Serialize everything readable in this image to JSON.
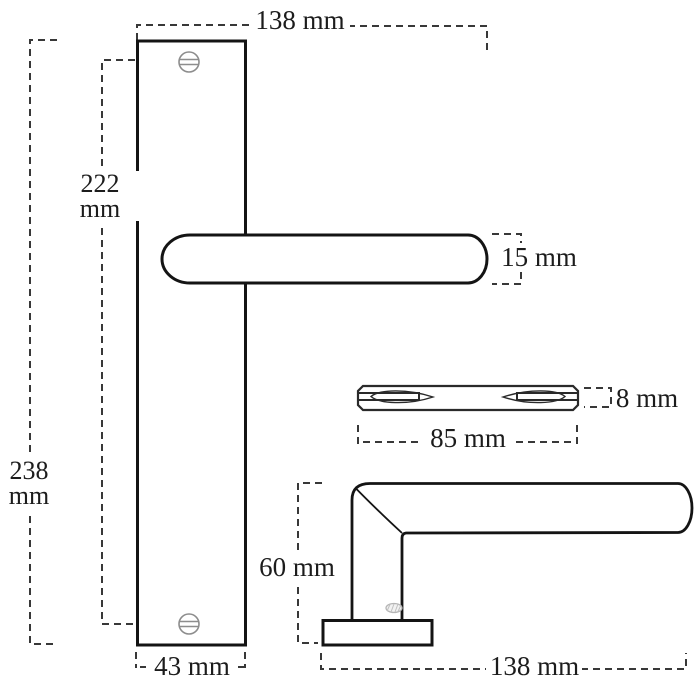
{
  "unit": "mm",
  "colors": {
    "background": "#ffffff",
    "outline": "#141414",
    "dimension_line": "#383838",
    "label_text": "#1c1c1c",
    "screw_gray": "#8d8d8d"
  },
  "dimensions": {
    "lever_length_top": {
      "text": "138 mm"
    },
    "screw_distance": {
      "value": "222",
      "unit": "mm"
    },
    "lever_thickness": {
      "text": "15 mm"
    },
    "spindle_thickness": {
      "text": "8 mm"
    },
    "spindle_length": {
      "text": "85 mm"
    },
    "plate_height": {
      "value": "238",
      "unit": "mm"
    },
    "handle_height_side": {
      "text": "60 mm"
    },
    "plate_width": {
      "text": "43 mm"
    },
    "handle_length_side": {
      "text": "138 mm"
    }
  }
}
